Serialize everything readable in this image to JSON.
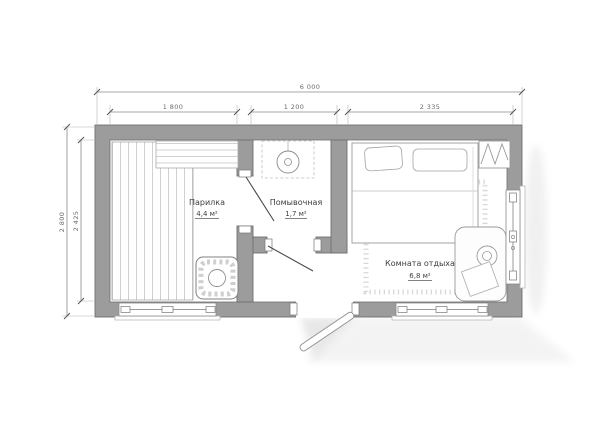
{
  "plan": {
    "type": "floor-plan",
    "rooms": [
      {
        "name": "Парилка",
        "area": "4,4 м²"
      },
      {
        "name": "Помывочная",
        "area": "1,7 м²"
      },
      {
        "name": "Комната отдыха",
        "area": "6,8 м²"
      }
    ],
    "dims": {
      "w_total": "6 000",
      "w1": "1 800",
      "w2": "1 200",
      "w3": "2 335",
      "h_outer": "2 800",
      "h_inner": "2 425"
    },
    "fixtures": [
      "bench-planks",
      "upper-bench",
      "stove",
      "shower",
      "bed",
      "pillows",
      "wardrobe",
      "rug",
      "table",
      "entrance-door",
      "windows"
    ],
    "colors": {
      "wall": "#9c9c9c",
      "wall_outline": "#6f6f6f",
      "dim_text": "#6b6b6b",
      "label_text": "#3f3f3f",
      "shadow": "#e9e9e9"
    }
  }
}
